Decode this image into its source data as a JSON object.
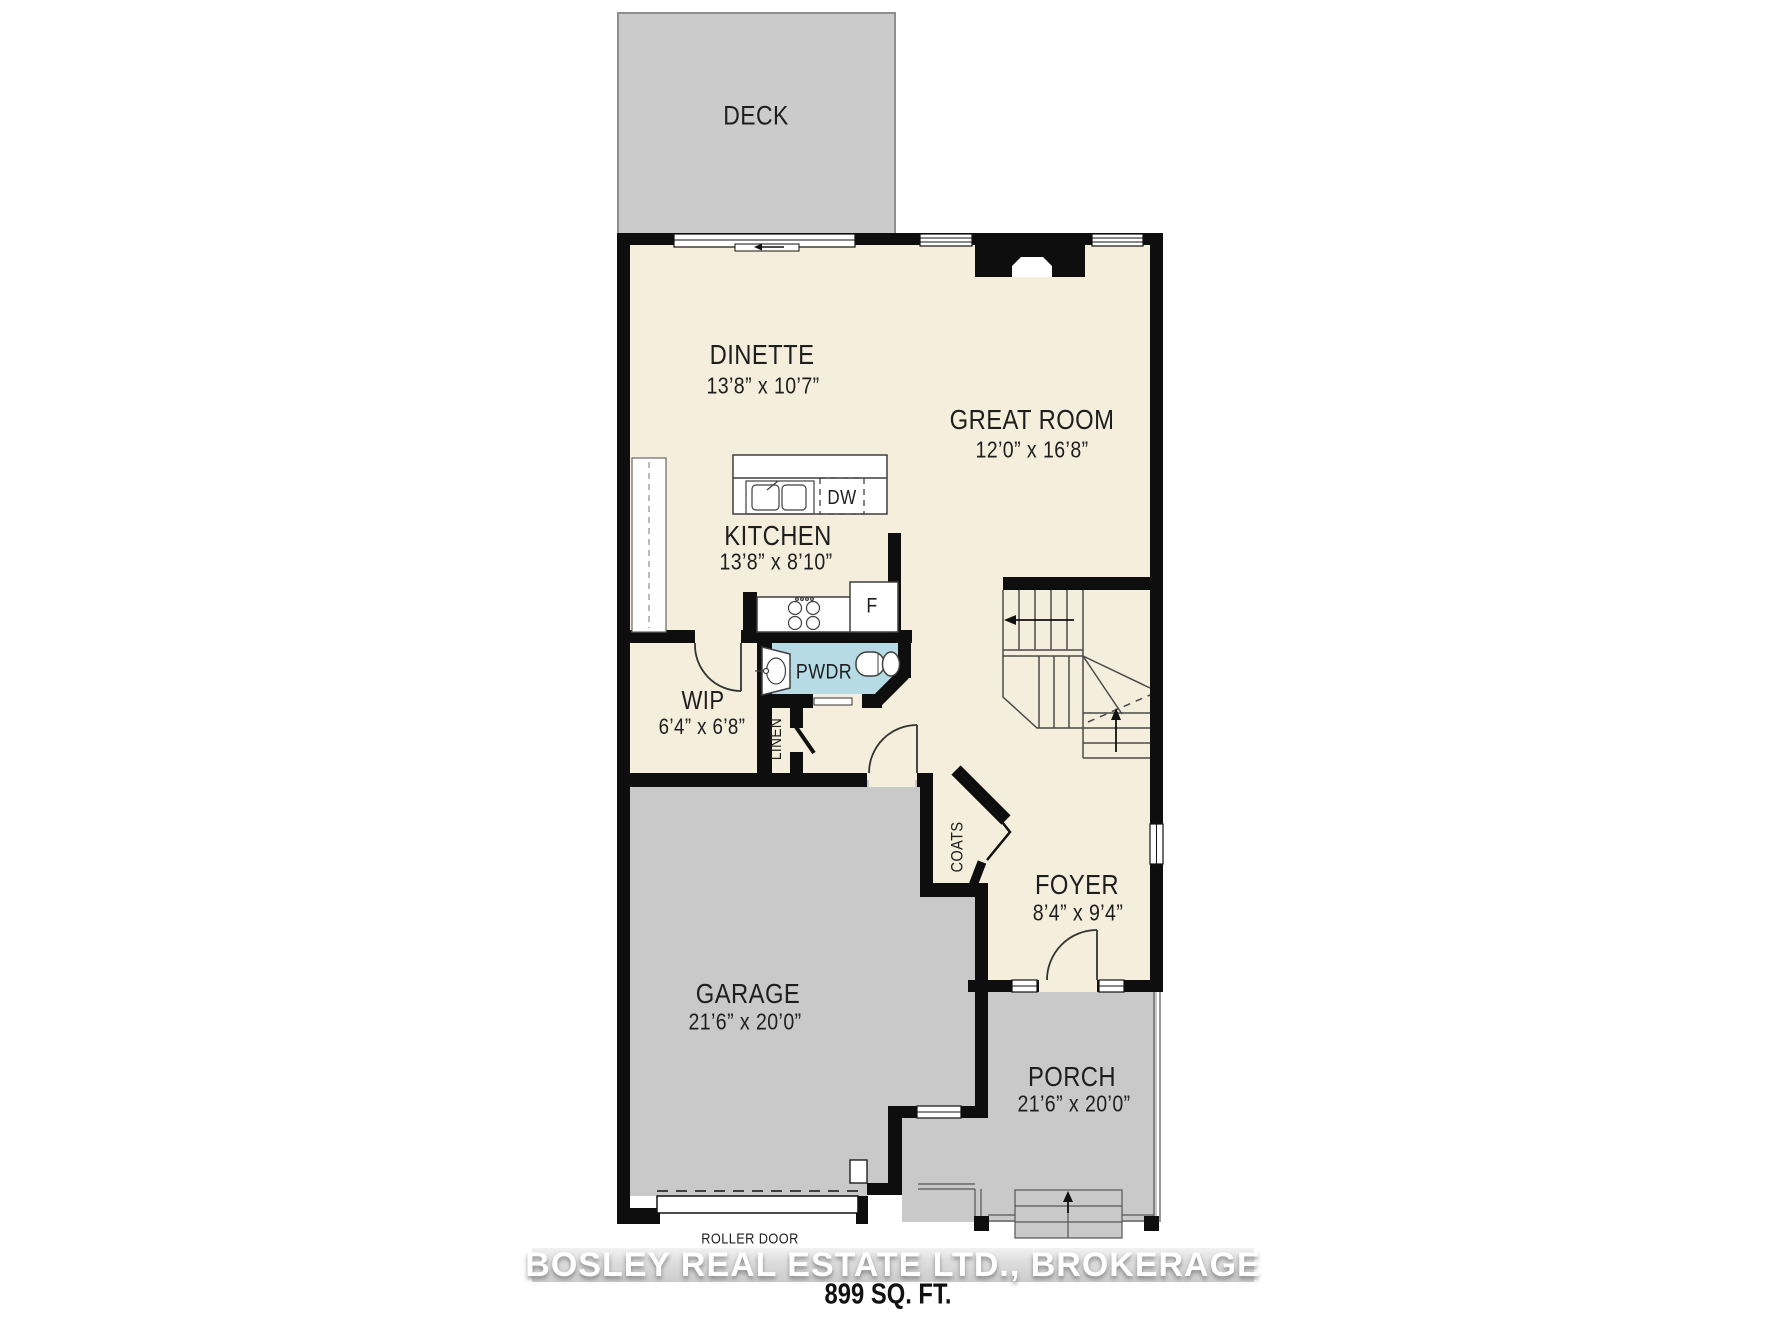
{
  "title": "Main floor plan",
  "colors": {
    "floor": "#f5eedc",
    "outdoor_gray": "#c9c9c9",
    "powder_room_blue": "#b6dbe5",
    "wall_black": "#0e0e0e"
  },
  "labels": {
    "deck": "DECK"
  },
  "rooms": {
    "dinette": {
      "name": "DINETTE",
      "dims": "13’8” x 10’7”"
    },
    "great_room": {
      "name": "GREAT ROOM",
      "dims": "12’0” x 16’8”"
    },
    "kitchen": {
      "name": "KITCHEN",
      "dims": "13’8” x 8’10”"
    },
    "wip": {
      "name": "WIP",
      "dims": "6’4” x 6’8”"
    },
    "pwdr": {
      "name": "PWDR"
    },
    "linen": {
      "name": "LINEN"
    },
    "coats": {
      "name": "COATS"
    },
    "foyer": {
      "name": "FOYER",
      "dims": "8’4” x 9’4”"
    },
    "garage": {
      "name": "GARAGE",
      "dims": "21’6” x 20’0”"
    },
    "porch": {
      "name": "PORCH",
      "dims": "21’6” x 20’0”"
    }
  },
  "appliances": {
    "dishwasher": "DW",
    "fridge": "F"
  },
  "annotations": {
    "roller_door": "ROLLER DOOR"
  },
  "footer": {
    "watermark": "BOSLEY REAL ESTATE LTD., BROKERAGE",
    "area": "899 SQ. FT."
  }
}
